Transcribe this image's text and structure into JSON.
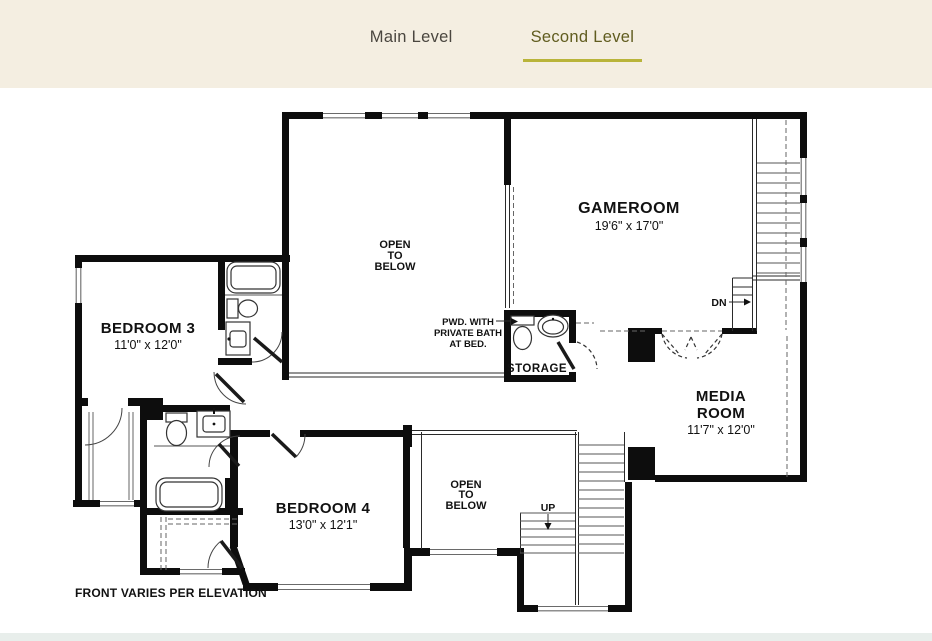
{
  "tabs": {
    "main": "Main Level",
    "second": "Second Level"
  },
  "colors": {
    "header_bg": "#f4eee1",
    "footer_bg": "#e8eeeb",
    "active_tab_text": "#605c1f",
    "inactive_tab_text": "#4a463f",
    "tab_underline": "#b9b43a",
    "plan_ink": "#0d0d0d"
  },
  "plan": {
    "rooms": {
      "gameroom": {
        "name": "GAMEROOM",
        "dims": "19'6\" x 17'0\""
      },
      "open_below_upper": {
        "line1": "OPEN",
        "line2": "TO",
        "line3": "BELOW"
      },
      "bedroom3": {
        "name": "BEDROOM 3",
        "dims": "11'0\" x 12'0\""
      },
      "media": {
        "name1": "MEDIA",
        "name2": "ROOM",
        "dims": "11'7\" x 12'0\""
      },
      "bedroom4": {
        "name": "BEDROOM 4",
        "dims": "13'0\" x 12'1\""
      },
      "open_below_lower": {
        "line1": "OPEN",
        "line2": "TO",
        "line3": "BELOW"
      },
      "storage": {
        "name": "STORAGE"
      }
    },
    "annotations": {
      "pwd_line1": "PWD. WITH",
      "pwd_line2": "PRIVATE BATH",
      "pwd_line3": "AT BED.",
      "dn": "DN",
      "up": "UP",
      "front_note": "FRONT VARIES PER ELEVATION"
    }
  }
}
